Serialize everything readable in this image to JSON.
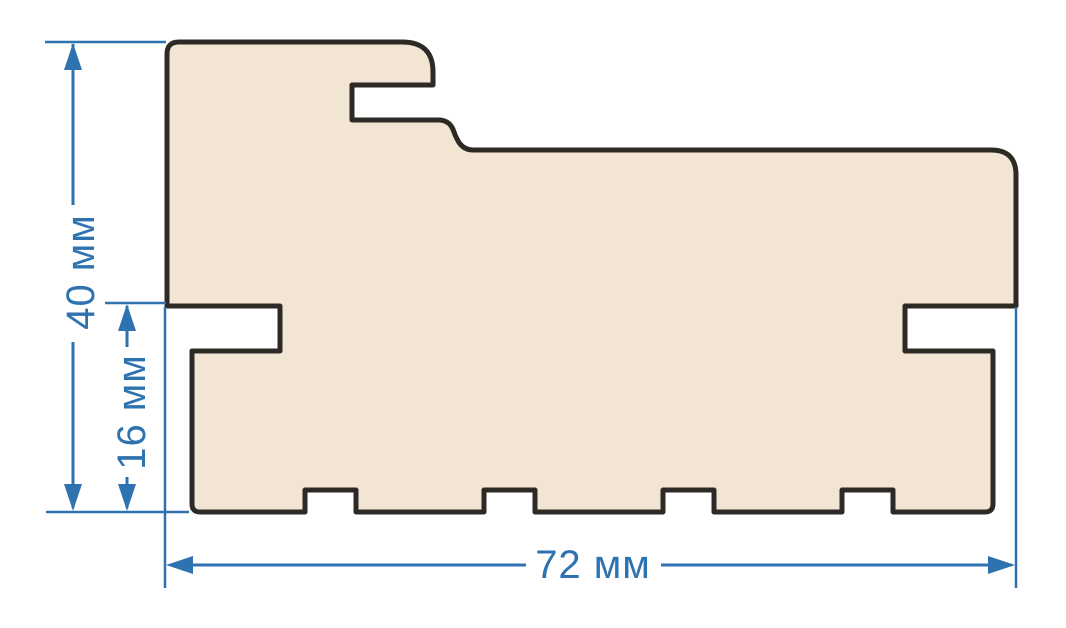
{
  "diagram": {
    "type": "technical-cross-section",
    "subject": "door frame profile section with dimensions",
    "dimensions": {
      "height_label": "40 мм",
      "rebate_label": "16 мм",
      "width_label": "72 мм"
    },
    "colors": {
      "background": "#ffffff",
      "profile_fill": "#f3e5d4",
      "profile_outline": "#2d2a26",
      "dimension_blue": "#2e72b0"
    }
  }
}
